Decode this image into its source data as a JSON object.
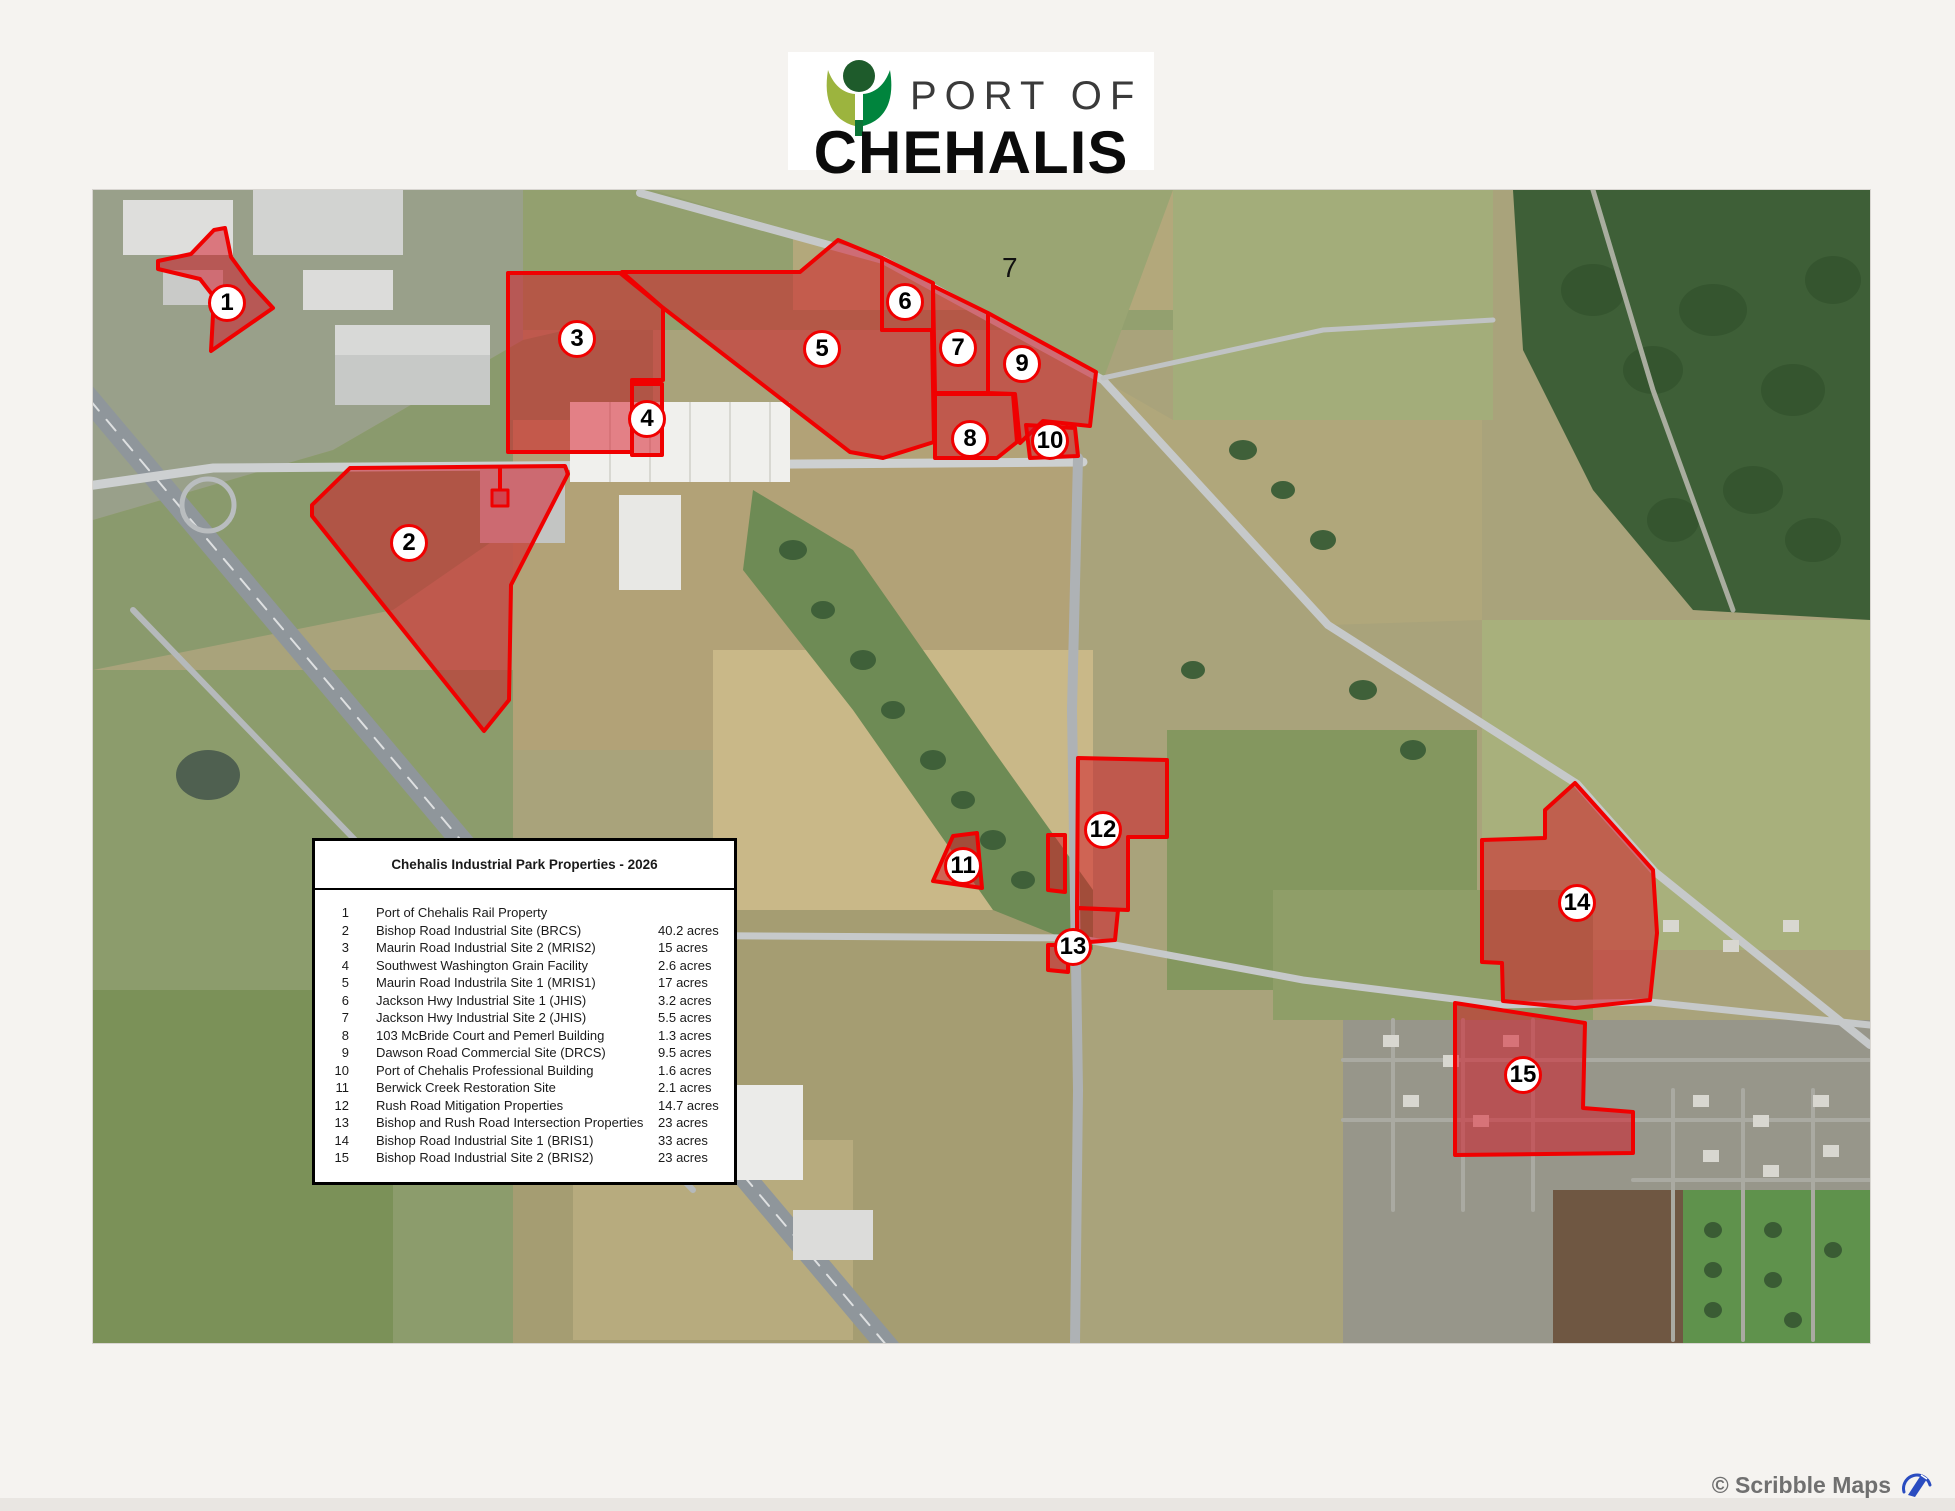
{
  "logo": {
    "top_text": "PORT OF",
    "name_text": "CHEHALIS"
  },
  "legend": {
    "title": "Chehalis Industrial Park Properties - 2026",
    "rows": [
      {
        "num": "1",
        "name": "Port of Chehalis Rail Property",
        "acres": ""
      },
      {
        "num": "2",
        "name": "Bishop Road Industrial Site (BRCS)",
        "acres": "40.2 acres"
      },
      {
        "num": "3",
        "name": "Maurin Road Industrial Site 2 (MRIS2)",
        "acres": "15 acres"
      },
      {
        "num": "4",
        "name": "Southwest Washington Grain Facility",
        "acres": "2.6 acres"
      },
      {
        "num": "5",
        "name": "Maurin Road Industrila Site 1 (MRIS1)",
        "acres": "17 acres"
      },
      {
        "num": "6",
        "name": "Jackson Hwy Industrial Site 1 (JHIS)",
        "acres": "3.2 acres"
      },
      {
        "num": "7",
        "name": "Jackson Hwy Industrial Site 2 (JHIS)",
        "acres": "5.5 acres"
      },
      {
        "num": "8",
        "name": "103 McBride Court and Pemerl Building",
        "acres": "1.3 acres"
      },
      {
        "num": "9",
        "name": "Dawson Road Commercial Site (DRCS)",
        "acres": "9.5 acres"
      },
      {
        "num": "10",
        "name": "Port of Chehalis Professional Building",
        "acres": "1.6 acres"
      },
      {
        "num": "11",
        "name": "Berwick Creek Restoration Site",
        "acres": "2.1 acres"
      },
      {
        "num": "12",
        "name": "Rush Road Mitigation Properties",
        "acres": "14.7 acres"
      },
      {
        "num": "13",
        "name": "Bishop and Rush Road Intersection Properties",
        "acres": "23 acres"
      },
      {
        "num": "14",
        "name": "Bishop Road Industrial Site 1 (BRIS1)",
        "acres": "33 acres"
      },
      {
        "num": "15",
        "name": "Bishop Road Industrial Site 2 (BRIS2)",
        "acres": "23 acres"
      }
    ]
  },
  "map": {
    "markers": [
      {
        "label": "1"
      },
      {
        "label": "2"
      },
      {
        "label": "3"
      },
      {
        "label": "4"
      },
      {
        "label": "5"
      },
      {
        "label": "6"
      },
      {
        "label": "7"
      },
      {
        "label": "8"
      },
      {
        "label": "9"
      },
      {
        "label": "10"
      },
      {
        "label": "11"
      },
      {
        "label": "12"
      },
      {
        "label": "13"
      },
      {
        "label": "14"
      },
      {
        "label": "15"
      }
    ],
    "stray_label": "7",
    "colors": {
      "highlight_stroke": "#f00000",
      "highlight_fill": "#d60f1f",
      "logo_light_green": "#9cb43e",
      "logo_dark_green": "#00843d",
      "logo_head_green": "#1e5b2b",
      "attribution_blue": "#2a4cc0"
    }
  },
  "attribution": {
    "text": "© Scribble Maps"
  }
}
